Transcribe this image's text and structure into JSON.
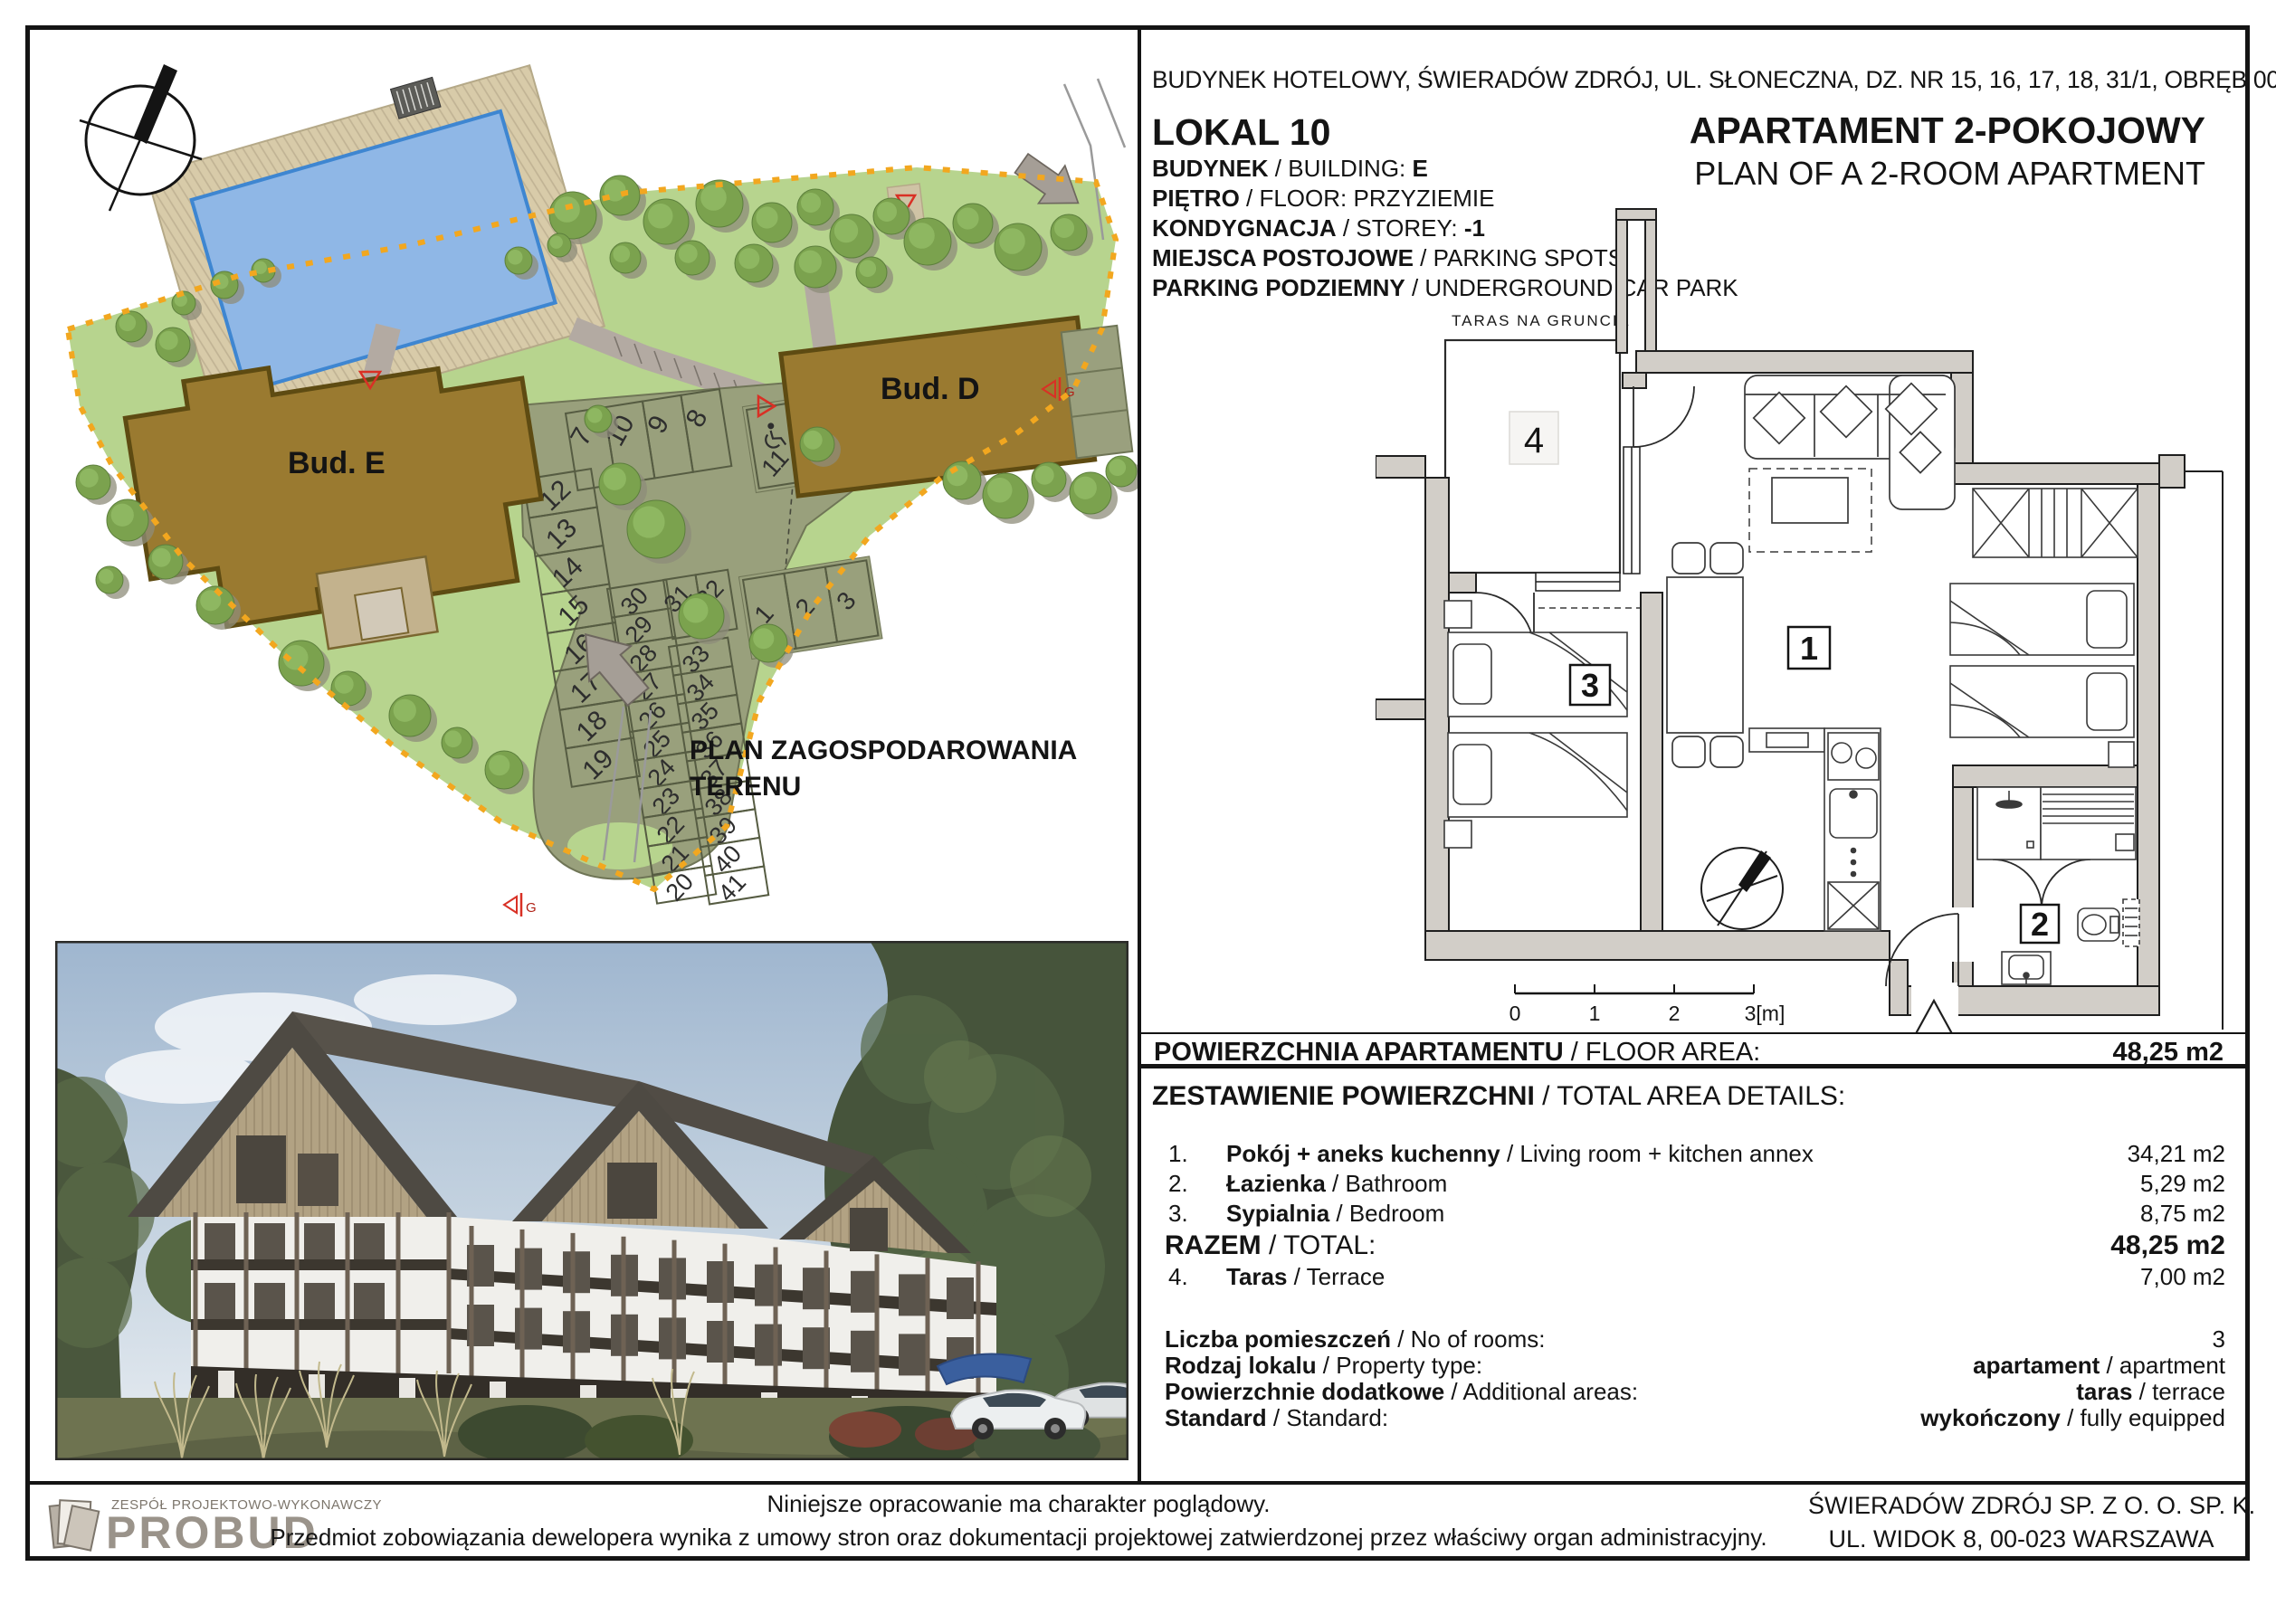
{
  "header": {
    "address": "BUDYNEK HOTELOWY, ŚWIERADÓW ZDRÓJ, UL. SŁONECZNA, DZ. NR 15, 16, 17, 18, 31/1, OBRĘB 0004",
    "unit": "LOKAL 10",
    "title_pl": "APARTAMENT 2-POKOJOWY",
    "title_en": "PLAN OF A 2-ROOM APARTMENT",
    "info_lines": [
      {
        "bold": "BUDYNEK",
        "rest": " / BUILDING: ",
        "value": "E"
      },
      {
        "bold": "PIĘTRO",
        "rest": " / FLOOR: PRZYZIEMIE",
        "value": ""
      },
      {
        "bold": "KONDYGNACJA",
        "rest": " / STOREY: ",
        "value": "-1"
      },
      {
        "bold": "MIEJSCA POSTOJOWE",
        "rest": " / PARKING SPOTS",
        "value": ""
      },
      {
        "bold": "PARKING PODZIEMNY",
        "rest": " / UNDERGROUND CAR PARK",
        "value": ""
      }
    ]
  },
  "site_plan": {
    "caption_line1": "PLAN ZAGOSPODAROWANIA",
    "caption_line2": "TERENU",
    "building_e": "Bud. E",
    "building_d": "Bud. D",
    "gate_letter": "G",
    "parking": {
      "top_row": [
        "7",
        "10",
        "9",
        "8"
      ],
      "left_column": [
        "12",
        "13",
        "14",
        "15",
        "16",
        "17",
        "18",
        "19"
      ],
      "middle_column": [
        "30",
        "29",
        "28",
        "27",
        "26",
        "25",
        "24",
        "23",
        "22",
        "21",
        "20"
      ],
      "pair": [
        "31",
        "32"
      ],
      "right_column": [
        "33",
        "34",
        "35",
        "36",
        "37",
        "38",
        "39",
        "40",
        "41"
      ],
      "disabled_row": [
        "11",
        "4"
      ],
      "bud_d_row": [
        "1",
        "2",
        "3"
      ]
    }
  },
  "floor_plan": {
    "terrace_note": "TARAS NA GRUNCIE",
    "room_living": "1",
    "room_bath": "2",
    "room_bedroom": "3",
    "room_terrace": "4",
    "scale_ticks": [
      "0",
      "1",
      "2",
      "3[m]"
    ]
  },
  "floor_area_row": {
    "label_bold": "POWIERZCHNIA APARTAMENTU",
    "label_rest": " / FLOOR AREA:",
    "value": "48,25 m2"
  },
  "area_details": {
    "title_bold": "ZESTAWIENIE POWIERZCHNI",
    "title_rest": " / TOTAL AREA DETAILS:",
    "rows": [
      {
        "num": "1.",
        "name_bold": "Pokój + aneks kuchenny",
        "name_rest": " / Living room + kitchen annex",
        "value": "34,21 m2",
        "total": false
      },
      {
        "num": "2.",
        "name_bold": "Łazienka",
        "name_rest": " / Bathroom",
        "value": "5,29 m2",
        "total": false
      },
      {
        "num": "3.",
        "name_bold": "Sypialnia",
        "name_rest": " / Bedroom",
        "value": "8,75 m2",
        "total": false
      },
      {
        "num": "",
        "name_bold": "RAZEM",
        "name_rest": " / TOTAL:",
        "value": "48,25 m2",
        "total": true
      },
      {
        "num": "4.",
        "name_bold": "Taras",
        "name_rest": " / Terrace",
        "value": "7,00 m2",
        "total": false
      }
    ]
  },
  "specs": [
    {
      "label_bold": "Liczba pomieszczeń",
      "label_rest": " / No of rooms:",
      "value_bold": "",
      "value_rest": "3"
    },
    {
      "label_bold": "Rodzaj lokalu",
      "label_rest": " / Property type:",
      "value_bold": "apartament",
      "value_rest": " / apartment"
    },
    {
      "label_bold": "Powierzchnie dodatkowe",
      "label_rest": " / Additional areas:",
      "value_bold": "taras",
      "value_rest": " / terrace"
    },
    {
      "label_bold": "Standard",
      "label_rest": " / Standard:",
      "value_bold": "wykończony",
      "value_rest": " / fully equipped"
    }
  ],
  "footer": {
    "logo_top": "ZESPÓŁ PROJEKTOWO-WYKONAWCZY",
    "logo_main": "PROBUD",
    "disclaimer_line1": "Niniejsze opracowanie ma charakter  poglądowy.",
    "disclaimer_line2": "Przedmiot zobowiązania dewelopera wynika z umowy stron oraz dokumentacji projektowej zatwierdzonej przez właściwy organ administracyjny.",
    "company_line1": "ŚWIERADÓW ZDRÓJ SP. Z O. O. SP. K.",
    "company_line2": "UL. WIDOK 8, 00-023 WARSZAWA"
  },
  "colors": {
    "accent_red": "#d93025",
    "terrain_green": "#b7d48e",
    "parking_olive": "#99a07c",
    "building_brown": "#9a7a30",
    "pool_blue": "#8fb7e6",
    "boundary_orange": "#f2a71f"
  }
}
